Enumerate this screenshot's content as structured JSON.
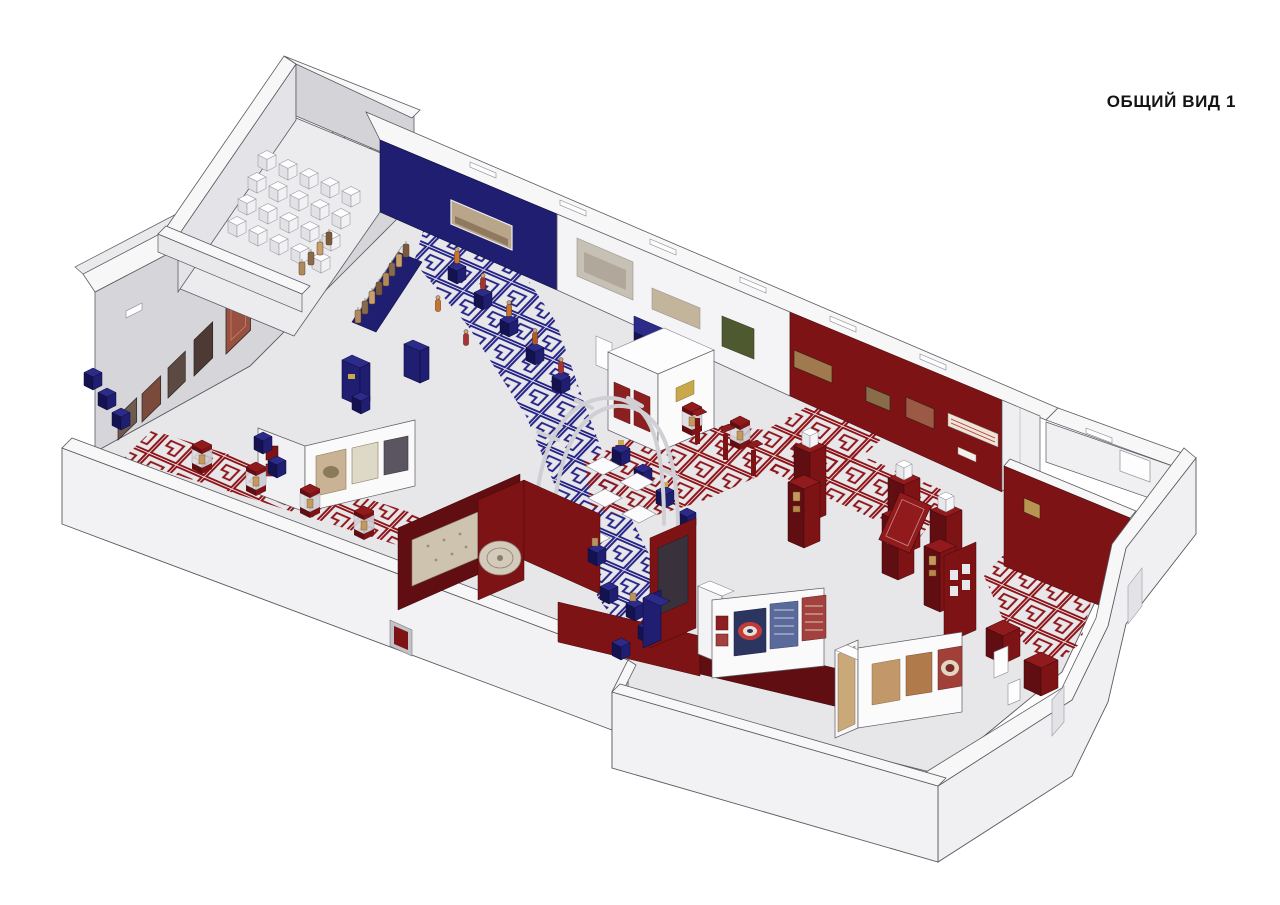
{
  "header": {
    "view_label": "ОБЩИЙ ВИД 1"
  },
  "palette": {
    "background": "#ffffff",
    "navy": "#201e70",
    "navy_mid": "#2d2b8a",
    "navy_dark": "#15134f",
    "maroon": "#7e1316",
    "maroon_light": "#911a1d",
    "maroon_dark": "#600e11",
    "pattern_blue": "#262486",
    "pattern_red": "#8e1418",
    "wall_white": "#f4f4f6",
    "wall_cap": "#f7f7f8",
    "wall_shade": "#d6d6da",
    "floor": "#e7e7ea",
    "floor_annex": "#ececef",
    "carpet_tan": "#cdc3ae",
    "outline": "#5a5a61"
  }
}
